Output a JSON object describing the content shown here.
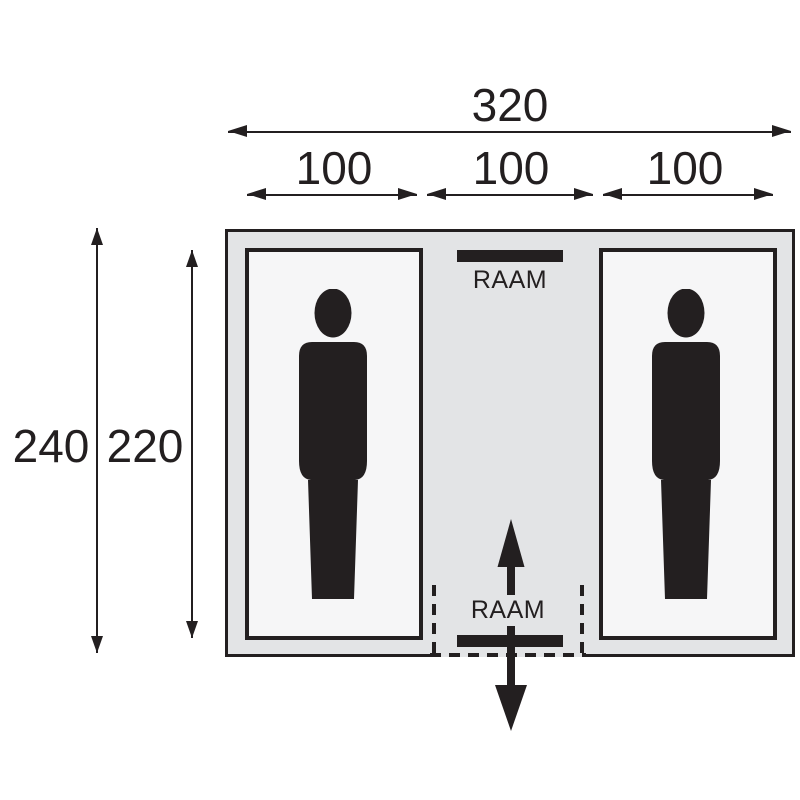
{
  "diagram": {
    "type": "tent-floorplan",
    "dimensions": {
      "total_width": "320",
      "section_widths": [
        "100",
        "100",
        "100"
      ],
      "outer_depth": "240",
      "inner_depth": "220"
    },
    "labels": {
      "window_top": "RAAM",
      "window_bottom": "RAAM"
    },
    "icons": [
      "person-silhouette-left",
      "person-silhouette-right",
      "door-arrow-in",
      "door-arrow-out"
    ],
    "colors": {
      "line": "#231f20",
      "tent_fill": "#e3e4e6",
      "cabin_fill": "#f6f6f7",
      "background": "#ffffff"
    }
  }
}
